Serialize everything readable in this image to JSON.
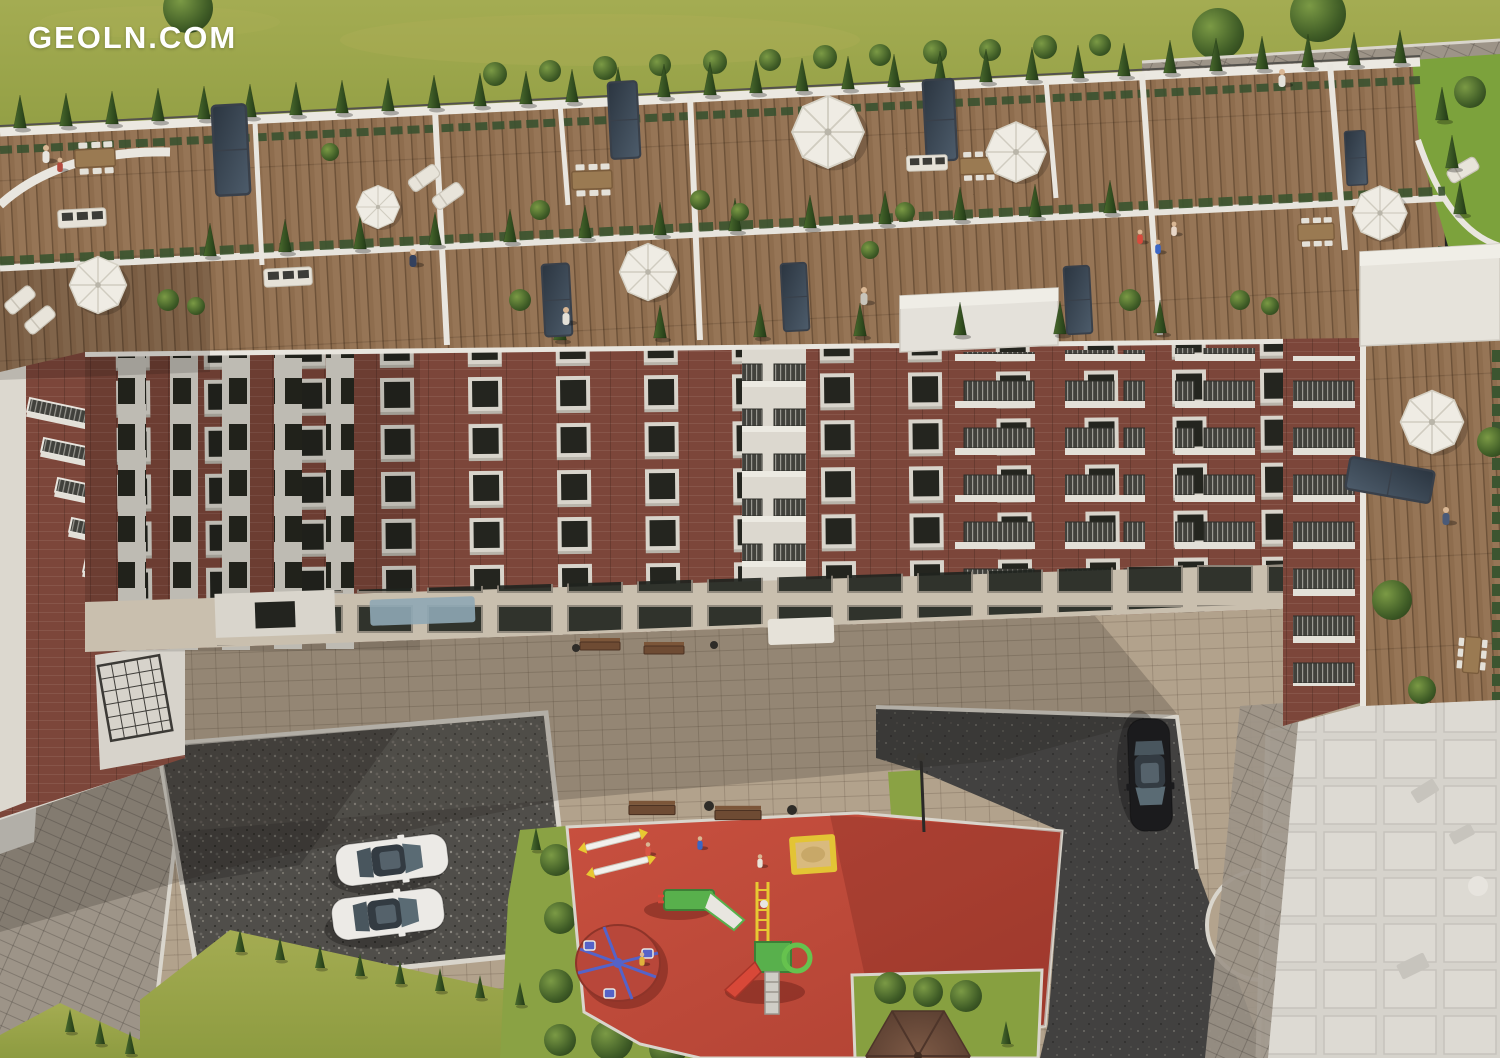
{
  "image": {
    "type": "3d-aerial-architectural-rendering",
    "width_px": 1500,
    "height_px": 1058,
    "subject": "Residential apartment complex seen from above: landscaped rooftop penthouse terraces, red-brick facade, inner courtyard with children's playground and parking"
  },
  "watermark": {
    "text": "GEOLN.COM",
    "color": "#ffffff",
    "position": "top-left"
  },
  "palette": {
    "lawn_top": "#99a444",
    "lawn_inner": "#7ca23c",
    "deck_wood": "#8e6d4e",
    "parapet_white": "#e9e6df",
    "cypress_green": "#2c451c",
    "hedge_green": "#3c5530",
    "brick_red": "#7c463a",
    "pilaster_white": "#d9d5cc",
    "window_dark": "#24251f",
    "ground_floor_stone": "#c9bfae",
    "courtyard_paving": "#b2a28c",
    "walkway_paving": "#9d9488",
    "gravel": "#504e4a",
    "asphalt": "#424140",
    "playground_red": "#c34c3d",
    "playground_green": "#58b04c",
    "playground_yellow": "#e8c832",
    "playground_blue": "#5563c8",
    "car_white": "#eceae6",
    "car_black": "#1b1b1d",
    "gazebo_roof": "#6e4d3d",
    "umbrella_white": "#efece4"
  },
  "scene": {
    "top_lawn": {
      "label": "public lawn with round topiary bushes",
      "path": "paved walking path with jogger (top right)"
    },
    "rooftop_terraces": {
      "label": "penthouse roof terraces",
      "features": [
        "wooden decking",
        "white parapet walls with railings",
        "rows of cypress trees in planters",
        "hedge planters",
        "white patio umbrellas",
        "dining tables with chairs",
        "sun loungers",
        "outdoor sofas",
        "dark glass skylights",
        "residents and children"
      ]
    },
    "building": {
      "label": "six-storey brick apartment building",
      "materials": [
        "red-brown brick",
        "white pilaster strips",
        "white cornice"
      ],
      "features": [
        "balconies with dark metal railings",
        "white window surrounds",
        "stone ground floor with glazing",
        "entrance canopies",
        "white rooftop service towers"
      ]
    },
    "courtyard": {
      "label": "inner courtyard",
      "surfaces": [
        "beige paving tiles",
        "grey paver walkway",
        "dark gravel parking lot",
        "asphalt drive"
      ],
      "playground": {
        "surface": "red rubber",
        "equipment": [
          "seesaw",
          "seesaw",
          "slide",
          "climbing frame with slide",
          "carousel",
          "sandbox"
        ],
        "children_visible": 4
      },
      "vehicles": {
        "white_cars_parked": 2,
        "black_car_parked": 1
      },
      "furniture": {
        "benches": 4,
        "litter_bins": 4,
        "street_lamp": 1
      },
      "structures": {
        "gazebo": 1,
        "pergola": 1
      },
      "vegetation": [
        "conifer rows",
        "round trimmed bushes",
        "lawn patches"
      ]
    },
    "neighbor_building": {
      "label": "white untextured neighbouring building (bottom right)"
    },
    "people_visible": 14,
    "umbrellas_visible": 7,
    "skylights_visible": 8
  }
}
